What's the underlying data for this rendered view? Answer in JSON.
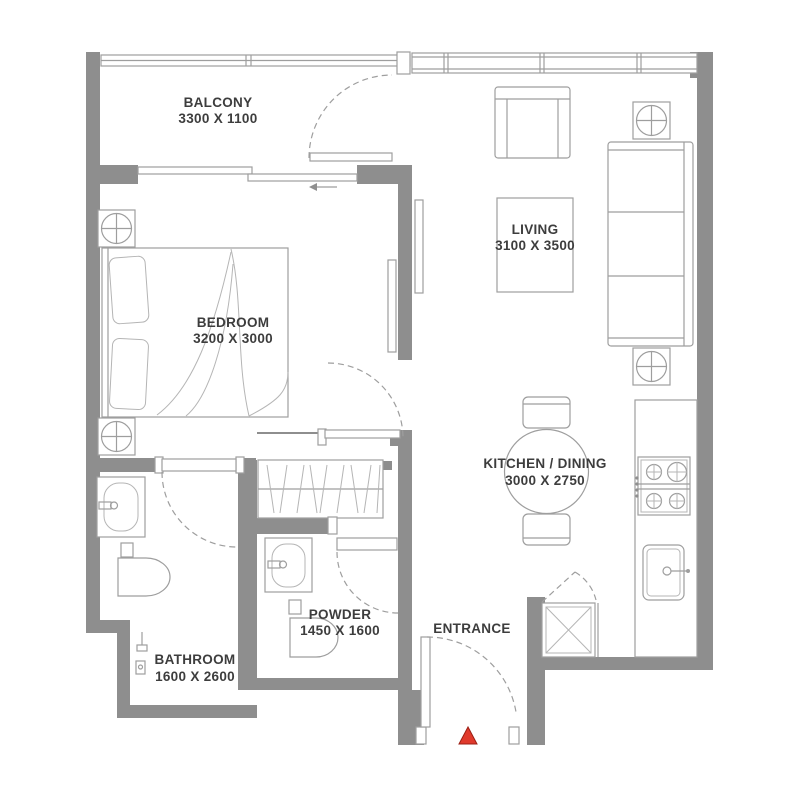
{
  "plan": {
    "title": "apartment-floor-plan",
    "rooms": [
      {
        "id": "balcony",
        "name": "BALCONY",
        "dims": "3300 X 1100"
      },
      {
        "id": "bedroom",
        "name": "BEDROOM",
        "dims": "3200 X 3000"
      },
      {
        "id": "living",
        "name": "LIVING",
        "dims": "3100 X 3500"
      },
      {
        "id": "kitchen_dining",
        "name": "KITCHEN / DINING",
        "dims": "3000 X 2750"
      },
      {
        "id": "bathroom",
        "name": "BATHROOM",
        "dims": "1600 X 2600"
      },
      {
        "id": "powder",
        "name": "POWDER",
        "dims": "1450 X 1600"
      },
      {
        "id": "entrance",
        "name": "ENTRANCE",
        "dims": ""
      }
    ],
    "icons": {
      "entry_marker": "red-triangle-entry-marker",
      "ac_symbol": "circle-in-square-ceiling-unit",
      "door_swing": "dashed-quarter-arc",
      "slider_arrow": "left-arrow"
    },
    "colors": {
      "background": "#ffffff",
      "wall": "#8e8e8e",
      "line": "#9e9e9e",
      "line_light": "#b5b5b5",
      "text": "#3d3d3d",
      "entry_marker": "#e03a2c",
      "entry_marker_edge": "#9c1f14"
    }
  }
}
